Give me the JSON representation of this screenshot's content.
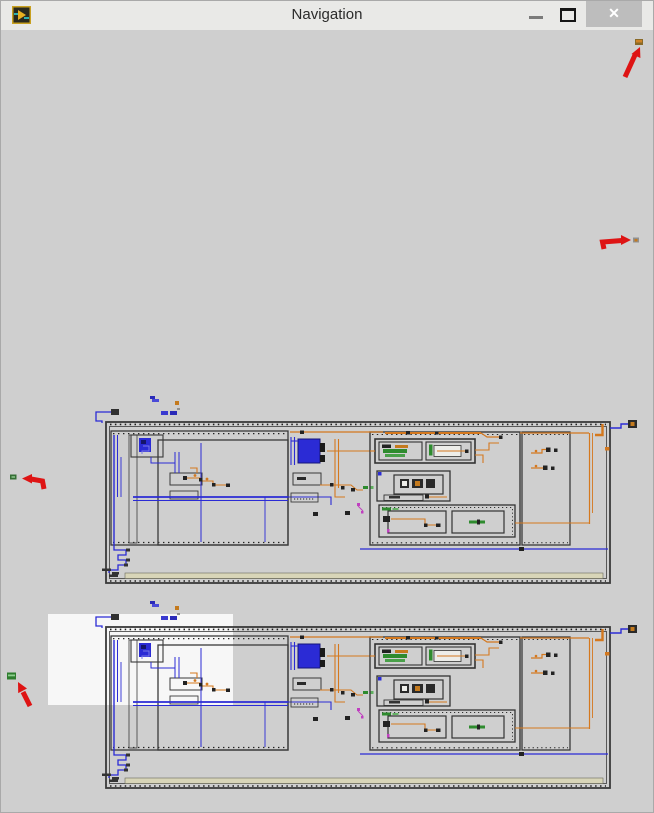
{
  "window": {
    "title": "Navigation",
    "app_icon": "labview-vi-icon",
    "controls": {
      "minimize": "minimize",
      "maximize": "maximize",
      "close": "✕"
    }
  },
  "colors": {
    "titlebar_bg": "#E9E9E7",
    "content_bg": "#CFCFCF",
    "close_button_bg": "#BDBDBD",
    "annotation_arrow": "#DE1414",
    "wire_blue": "#2B2BD5",
    "wire_orange": "#D4781E",
    "structure_border": "#3A3A3A",
    "node_green": "#2E8B2E",
    "viewport_highlight": "#FFFFFF",
    "strip_beige": "#D8D5B8"
  },
  "content": {
    "diagram_thumbnails": [
      {
        "name": "block-diagram-thumbnail-top"
      },
      {
        "name": "block-diagram-thumbnail-bottom"
      }
    ],
    "viewport_highlight_visible": true,
    "annotation_arrows": [
      {
        "direction": "up-right",
        "position": "top-right"
      },
      {
        "direction": "right",
        "position": "middle-right"
      },
      {
        "direction": "left",
        "position": "middle-left"
      },
      {
        "direction": "up-left",
        "position": "bottom-left"
      }
    ]
  }
}
